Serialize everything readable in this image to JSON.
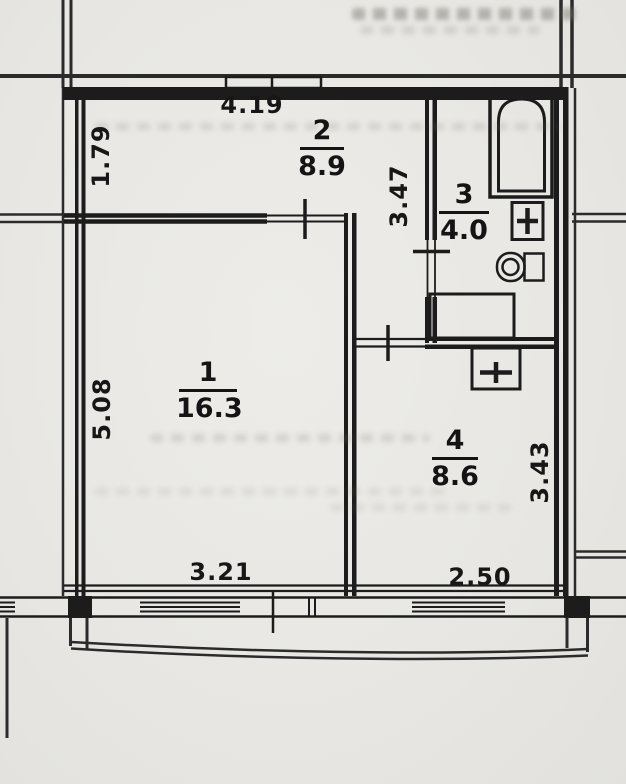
{
  "plan": {
    "title": "apartment-floor-plan",
    "rooms": [
      {
        "id": "room-1",
        "number": "1",
        "area": "16.3"
      },
      {
        "id": "room-2",
        "number": "2",
        "area": "8.9"
      },
      {
        "id": "room-3",
        "number": "3",
        "area": "4.0"
      },
      {
        "id": "room-4",
        "number": "4",
        "area": "8.6"
      }
    ],
    "dimensions": [
      {
        "id": "dim-top-width",
        "value": "4.19",
        "orientation": "horizontal"
      },
      {
        "id": "dim-room2-left",
        "value": "1.79",
        "orientation": "vertical"
      },
      {
        "id": "dim-corridor",
        "value": "3.47",
        "orientation": "vertical"
      },
      {
        "id": "dim-room1-left",
        "value": "5.08",
        "orientation": "vertical"
      },
      {
        "id": "dim-room4-right",
        "value": "3.43",
        "orientation": "vertical"
      },
      {
        "id": "dim-bottom-left",
        "value": "3.21",
        "orientation": "horizontal"
      },
      {
        "id": "dim-bottom-right",
        "value": "2.50",
        "orientation": "horizontal"
      }
    ],
    "fixtures": [
      "bathtub",
      "bathroom-sink",
      "toilet",
      "washing-machine",
      "kitchen-sink"
    ],
    "colors": {
      "paper": "#e8e7e3",
      "ink": "#1c1c1c",
      "grid": "#2b2b2b",
      "bleed": "#b9b7b1"
    }
  }
}
